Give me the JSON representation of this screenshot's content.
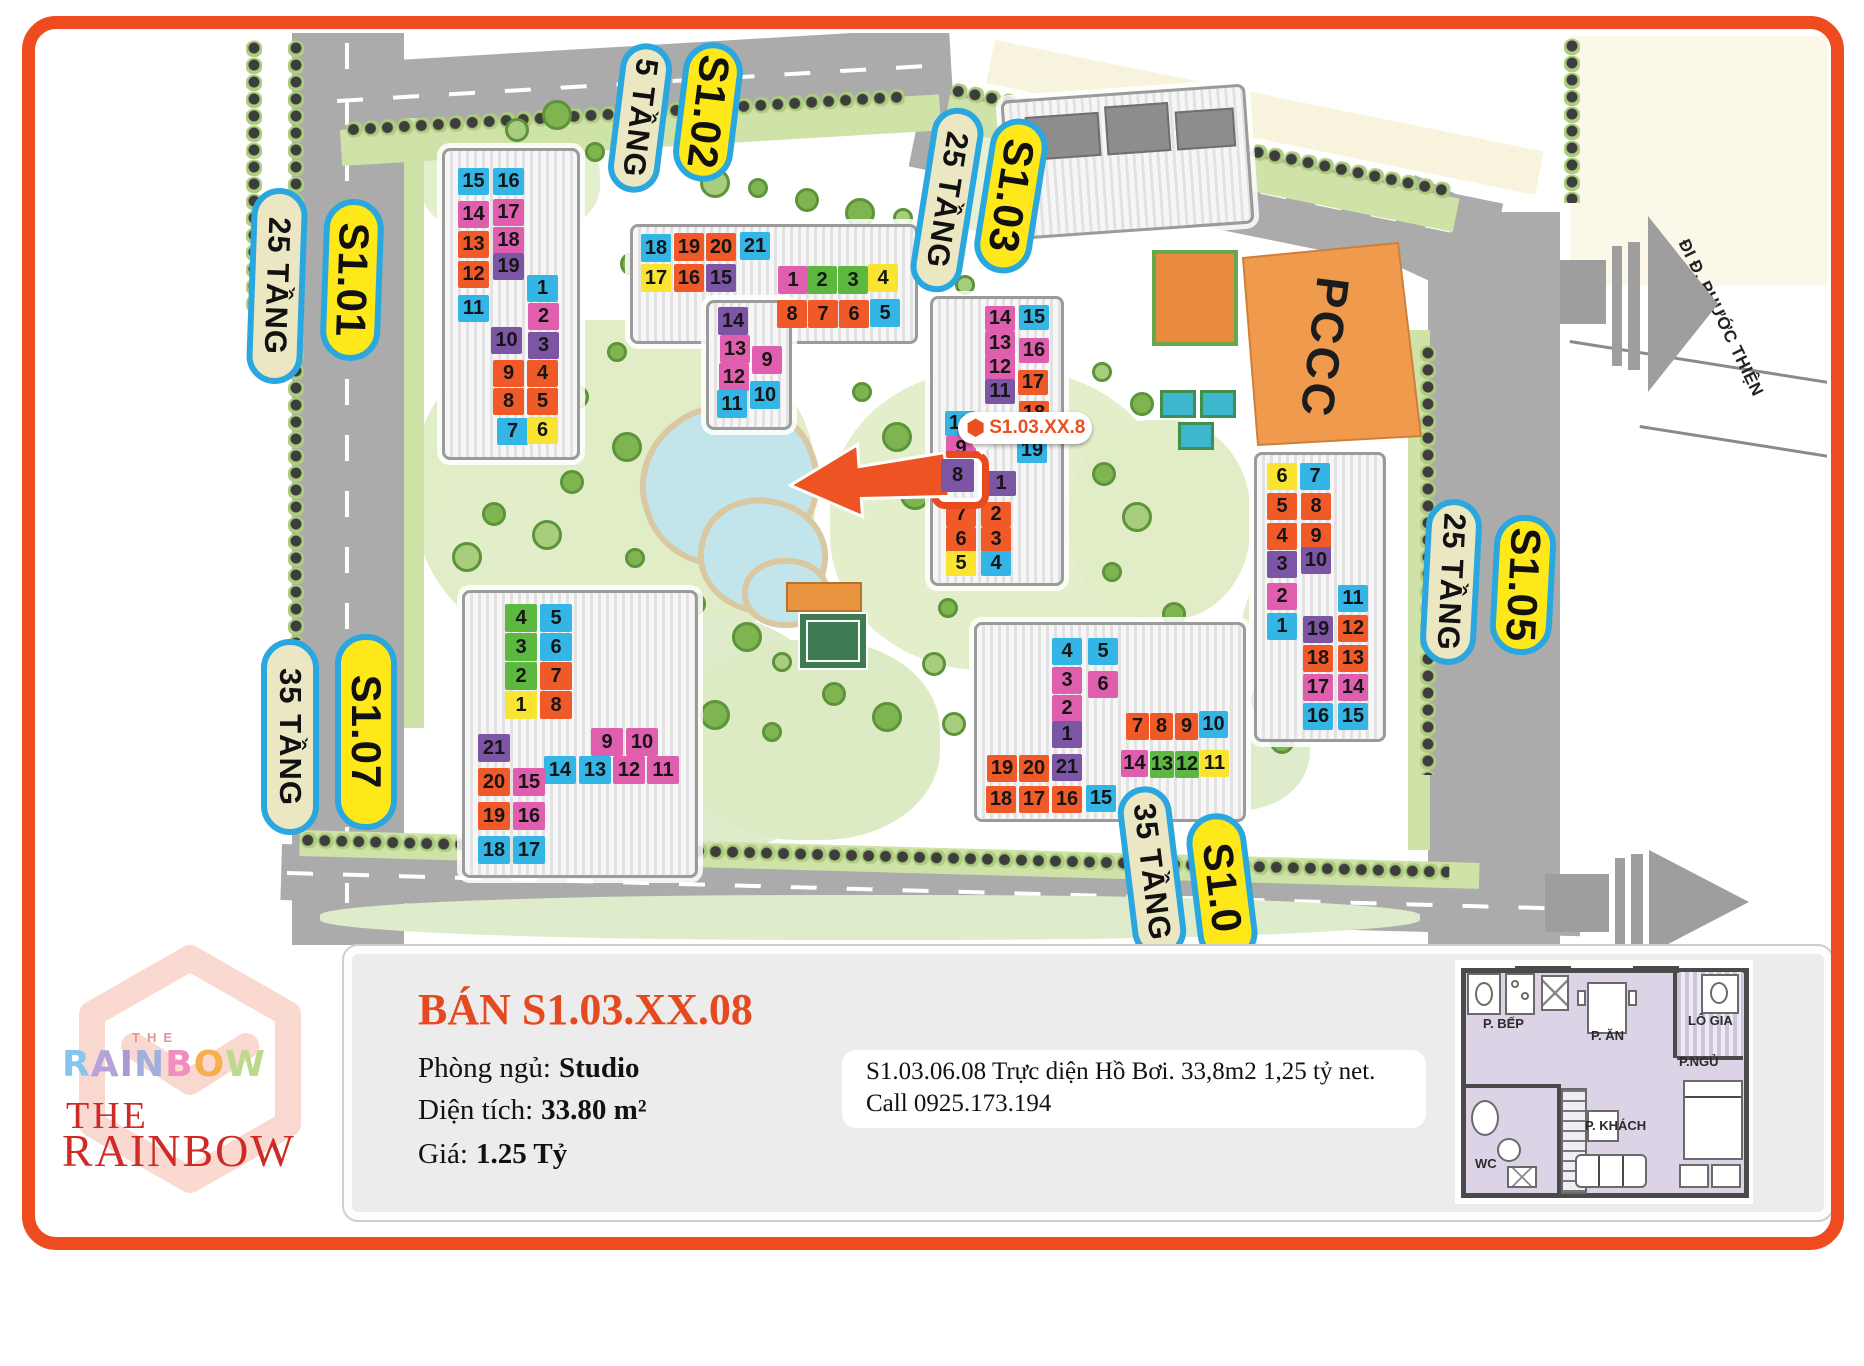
{
  "map": {
    "palette": {
      "cyan": "#33b5e5",
      "pink": "#df5fae",
      "orange": "#f05a28",
      "purple": "#7d55a5",
      "yellow": "#f9e431",
      "green": "#5cb83f"
    },
    "labels": [
      {
        "t": "25 TẦNG",
        "s": "cream",
        "x": 277,
        "y": 286,
        "l": 196,
        "w": 56,
        "r": 92
      },
      {
        "t": "S1.01",
        "s": "yellow",
        "x": 352,
        "y": 280,
        "l": 162,
        "w": 60,
        "r": 92
      },
      {
        "t": "5 TẦNG",
        "s": "cream",
        "x": 640,
        "y": 118,
        "l": 150,
        "w": 52,
        "r": 97
      },
      {
        "t": "S1.02",
        "s": "yellow",
        "x": 708,
        "y": 112,
        "l": 140,
        "w": 60,
        "r": 97
      },
      {
        "t": "25 TẦNG",
        "s": "cream",
        "x": 947,
        "y": 200,
        "l": 186,
        "w": 52,
        "r": 99
      },
      {
        "t": "S1.03",
        "s": "yellow",
        "x": 1011,
        "y": 196,
        "l": 156,
        "w": 58,
        "r": 99
      },
      {
        "t": "25 TẦNG",
        "s": "cream",
        "x": 1451,
        "y": 582,
        "l": 166,
        "w": 56,
        "r": 93
      },
      {
        "t": "S1.05",
        "s": "yellow",
        "x": 1523,
        "y": 585,
        "l": 140,
        "w": 62,
        "r": 93
      },
      {
        "t": "35 TẦNG",
        "s": "cream",
        "x": 290,
        "y": 737,
        "l": 196,
        "w": 58,
        "r": 90
      },
      {
        "t": "S1.07",
        "s": "yellow",
        "x": 366,
        "y": 732,
        "l": 196,
        "w": 62,
        "r": 90
      },
      {
        "t": "35 TẦNG",
        "s": "cream",
        "x": 1152,
        "y": 872,
        "l": 172,
        "w": 54,
        "r": 83
      },
      {
        "t": "S1.0",
        "s": "yellow",
        "x": 1222,
        "y": 888,
        "l": 150,
        "w": 60,
        "r": 83
      }
    ],
    "buildings": [
      {
        "name": "S1.01",
        "cw": 31,
        "ch": 27,
        "rects": [
          [
            442,
            148,
            138,
            312
          ]
        ],
        "cells": [
          [
            "15",
            "cyan",
            458,
            168
          ],
          [
            "16",
            "cyan",
            493,
            168
          ],
          [
            "14",
            "pink",
            458,
            201
          ],
          [
            "17",
            "pink",
            493,
            199
          ],
          [
            "13",
            "orange",
            458,
            231
          ],
          [
            "18",
            "pink",
            493,
            227
          ],
          [
            "12",
            "orange",
            458,
            261
          ],
          [
            "19",
            "purple",
            493,
            253
          ],
          [
            "11",
            "cyan",
            458,
            295
          ],
          [
            "1",
            "cyan",
            527,
            275
          ],
          [
            "2",
            "pink",
            528,
            303
          ],
          [
            "10",
            "purple",
            491,
            327
          ],
          [
            "3",
            "purple",
            528,
            332
          ],
          [
            "9",
            "orange",
            493,
            360
          ],
          [
            "4",
            "orange",
            527,
            360
          ],
          [
            "8",
            "orange",
            493,
            388
          ],
          [
            "5",
            "orange",
            527,
            388
          ],
          [
            "7",
            "cyan",
            497,
            418
          ],
          [
            "6",
            "yellow",
            527,
            417
          ]
        ]
      },
      {
        "name": "S1.02",
        "cw": 30,
        "ch": 28,
        "rects": [
          [
            630,
            224,
            288,
            120
          ],
          [
            706,
            300,
            86,
            130
          ]
        ],
        "cells": [
          [
            "18",
            "cyan",
            641,
            234
          ],
          [
            "19",
            "orange",
            674,
            233
          ],
          [
            "20",
            "orange",
            706,
            233
          ],
          [
            "21",
            "cyan",
            740,
            232
          ],
          [
            "17",
            "yellow",
            641,
            264
          ],
          [
            "16",
            "orange",
            674,
            264
          ],
          [
            "15",
            "purple",
            706,
            264
          ],
          [
            "14",
            "purple",
            718,
            307
          ],
          [
            "13",
            "pink",
            720,
            335
          ],
          [
            "12",
            "pink",
            719,
            363
          ],
          [
            "11",
            "cyan",
            717,
            390
          ],
          [
            "9",
            "pink",
            752,
            346
          ],
          [
            "10",
            "cyan",
            750,
            381
          ],
          [
            "1",
            "pink",
            778,
            266
          ],
          [
            "2",
            "green",
            807,
            266
          ],
          [
            "3",
            "green",
            838,
            266
          ],
          [
            "4",
            "yellow",
            868,
            264
          ],
          [
            "8",
            "orange",
            777,
            300
          ],
          [
            "7",
            "orange",
            808,
            300
          ],
          [
            "6",
            "orange",
            839,
            300
          ],
          [
            "5",
            "cyan",
            870,
            299
          ]
        ]
      },
      {
        "name": "S1.03",
        "cw": 30,
        "ch": 25,
        "rects": [
          [
            930,
            296,
            134,
            290
          ]
        ],
        "cells": [
          [
            "14",
            "pink",
            985,
            306
          ],
          [
            "15",
            "cyan",
            1019,
            305
          ],
          [
            "13",
            "pink",
            985,
            331
          ],
          [
            "16",
            "pink",
            1019,
            338
          ],
          [
            "12",
            "pink",
            985,
            355
          ],
          [
            "17",
            "orange",
            1018,
            370
          ],
          [
            "11",
            "purple",
            985,
            379
          ],
          [
            "18",
            "orange",
            1019,
            401
          ],
          [
            "10",
            "cyan",
            945,
            411
          ],
          [
            "9",
            "pink",
            946,
            436
          ],
          [
            "19",
            "cyan",
            1017,
            438
          ],
          [
            "8",
            "purple",
            941,
            459,
            33,
            33,
            1
          ],
          [
            "1",
            "purple",
            986,
            471
          ],
          [
            "7",
            "orange",
            946,
            502
          ],
          [
            "2",
            "orange",
            981,
            502
          ],
          [
            "6",
            "orange",
            946,
            527
          ],
          [
            "3",
            "orange",
            981,
            527
          ],
          [
            "5",
            "yellow",
            946,
            551
          ],
          [
            "4",
            "cyan",
            981,
            551
          ]
        ]
      },
      {
        "name": "S1.05",
        "cw": 30,
        "ch": 27,
        "rects": [
          [
            1254,
            452,
            132,
            290
          ]
        ],
        "cells": [
          [
            "6",
            "yellow",
            1267,
            463
          ],
          [
            "7",
            "cyan",
            1300,
            463
          ],
          [
            "5",
            "orange",
            1267,
            493
          ],
          [
            "8",
            "orange",
            1301,
            493
          ],
          [
            "4",
            "orange",
            1267,
            523
          ],
          [
            "9",
            "orange",
            1301,
            523
          ],
          [
            "3",
            "purple",
            1267,
            551
          ],
          [
            "10",
            "purple",
            1301,
            547
          ],
          [
            "2",
            "pink",
            1267,
            583
          ],
          [
            "11",
            "cyan",
            1338,
            585
          ],
          [
            "1",
            "cyan",
            1267,
            613
          ],
          [
            "19",
            "purple",
            1303,
            616
          ],
          [
            "12",
            "orange",
            1338,
            615
          ],
          [
            "18",
            "orange",
            1303,
            645
          ],
          [
            "13",
            "orange",
            1338,
            645
          ],
          [
            "17",
            "pink",
            1303,
            674
          ],
          [
            "14",
            "pink",
            1338,
            674
          ],
          [
            "16",
            "cyan",
            1303,
            703
          ],
          [
            "15",
            "cyan",
            1338,
            703
          ]
        ]
      },
      {
        "name": "S1.06",
        "cw": 30,
        "ch": 27,
        "rects": [
          [
            974,
            622,
            272,
            200
          ]
        ],
        "cells": [
          [
            "4",
            "cyan",
            1052,
            638
          ],
          [
            "5",
            "cyan",
            1088,
            638
          ],
          [
            "3",
            "pink",
            1052,
            667
          ],
          [
            "6",
            "pink",
            1088,
            671
          ],
          [
            "2",
            "pink",
            1052,
            695
          ],
          [
            "1",
            "purple",
            1052,
            721
          ],
          [
            "19",
            "orange",
            987,
            755
          ],
          [
            "20",
            "orange",
            1019,
            755
          ],
          [
            "21",
            "purple",
            1052,
            754
          ],
          [
            "18",
            "orange",
            986,
            786
          ],
          [
            "17",
            "orange",
            1019,
            786
          ],
          [
            "16",
            "orange",
            1052,
            786
          ],
          [
            "15",
            "cyan",
            1086,
            785
          ],
          [
            "7",
            "orange",
            1126,
            713,
            23
          ],
          [
            "8",
            "orange",
            1150,
            713,
            23
          ],
          [
            "9",
            "orange",
            1175,
            713,
            23
          ],
          [
            "10",
            "cyan",
            1199,
            711,
            29
          ],
          [
            "14",
            "pink",
            1121,
            750,
            27
          ],
          [
            "13",
            "green",
            1150,
            751,
            24
          ],
          [
            "12",
            "green",
            1175,
            751,
            24
          ],
          [
            "11",
            "yellow",
            1200,
            750,
            29
          ]
        ]
      },
      {
        "name": "S1.07",
        "cw": 32,
        "ch": 28,
        "rects": [
          [
            462,
            590,
            236,
            288
          ]
        ],
        "cells": [
          [
            "4",
            "green",
            505,
            604
          ],
          [
            "5",
            "cyan",
            540,
            604
          ],
          [
            "3",
            "green",
            505,
            633
          ],
          [
            "6",
            "cyan",
            540,
            633
          ],
          [
            "2",
            "green",
            505,
            662
          ],
          [
            "7",
            "orange",
            540,
            662
          ],
          [
            "1",
            "yellow",
            505,
            691
          ],
          [
            "8",
            "orange",
            540,
            691
          ],
          [
            "9",
            "pink",
            591,
            728
          ],
          [
            "10",
            "pink",
            626,
            728
          ],
          [
            "14",
            "cyan",
            544,
            756
          ],
          [
            "13",
            "cyan",
            579,
            756
          ],
          [
            "12",
            "pink",
            613,
            756
          ],
          [
            "11",
            "pink",
            647,
            756
          ],
          [
            "21",
            "purple",
            478,
            734
          ],
          [
            "20",
            "orange",
            478,
            768
          ],
          [
            "15",
            "pink",
            513,
            768
          ],
          [
            "19",
            "orange",
            478,
            802
          ],
          [
            "16",
            "pink",
            513,
            802
          ],
          [
            "18",
            "cyan",
            478,
            836
          ],
          [
            "17",
            "cyan",
            513,
            836
          ]
        ]
      }
    ],
    "marker": {
      "text": "S1.03.XX.8"
    },
    "pccc_label": "PCCC",
    "road_sign": "ĐI Đ. PHƯỚC THIỆN"
  },
  "panel": {
    "title": "BÁN S1.03.XX.08",
    "rows": [
      {
        "label": "Phòng ngủ:",
        "value": "Studio"
      },
      {
        "label": "Diện tích:",
        "value": "33.80 m²"
      },
      {
        "label": "Giá:",
        "value": "1.25 Tỷ"
      }
    ],
    "note": {
      "line1": "S1.03.06.08 Trực diện Hồ Bơi. 33,8m2 1,25 tỷ net.",
      "line2": "Call 0925.173.194"
    }
  },
  "logo": {
    "the_top": "THE",
    "rainbow_top": [
      [
        "R",
        "#85c7ec"
      ],
      [
        "A",
        "#b4a2d9"
      ],
      [
        "I",
        "#a89ad1"
      ],
      [
        "N",
        "#9fb0e0"
      ],
      [
        "B",
        "#ef8fc0"
      ],
      [
        "O",
        "#f5b04c"
      ],
      [
        "W",
        "#bcd98b"
      ]
    ],
    "the_red": "THE",
    "rainbow_red": "RAINBOW",
    "red": "#ce2a26"
  },
  "floorplan": {
    "rooms": [
      {
        "n": "P. BẾP",
        "x": 28,
        "y": 56
      },
      {
        "n": "P. ĂN",
        "x": 136,
        "y": 68
      },
      {
        "n": "LÔ GIA",
        "x": 233,
        "y": 53
      },
      {
        "n": "P.NGỦ",
        "x": 224,
        "y": 94
      },
      {
        "n": "P. KHÁCH",
        "x": 130,
        "y": 158
      },
      {
        "n": "WC",
        "x": 20,
        "y": 196
      }
    ]
  }
}
